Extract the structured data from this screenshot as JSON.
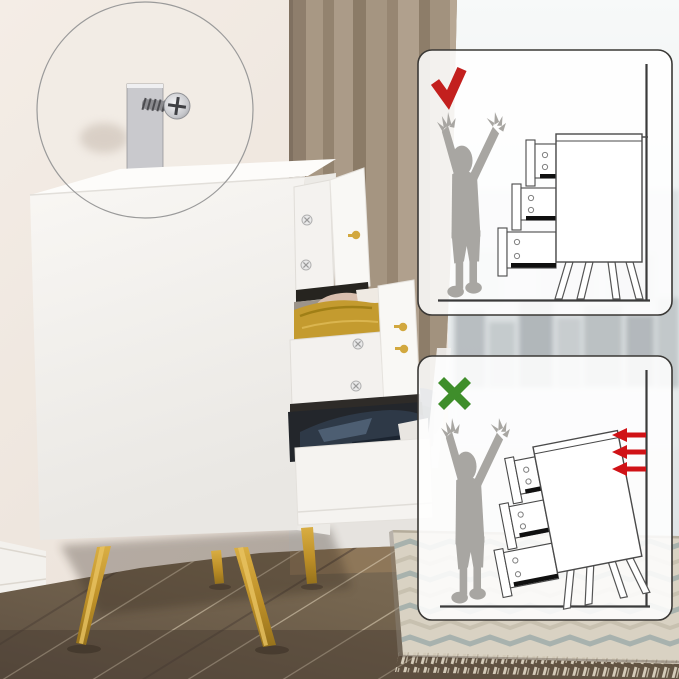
{
  "scene": {
    "kind": "furniture-product-photo",
    "subject": "white-dresser-with-gold-legs-and-open-drawers",
    "feature": "anti-tip-wall-anchor-kit",
    "environment": [
      "bedroom-wall",
      "curtain",
      "window-city-view",
      "wood-floor",
      "tassel-rug"
    ]
  },
  "magnifier": {
    "icon": "magnifier-circle",
    "shows": "metal-anchor-strap-and-screw"
  },
  "panels": {
    "secured": {
      "icon": "check-icon",
      "scene": "child-reaching-dresser-anchored-to-wall-stays-upright"
    },
    "unsecured": {
      "icon": "x-icon",
      "scene": "child-reaching-unanchored-dresser-tips-forward",
      "force_arrows": 3
    }
  },
  "colors": {
    "wall": "#efe7df",
    "curtain": "#a3937f",
    "curtain_dark": "#8b7b67",
    "window_haze": "#eef1f2",
    "city": "#aeb4b8",
    "floor": "#74644f",
    "plank_seam": "#d9cbb2",
    "rug_base": "#d9d2c3",
    "rug_stripe": "#9fadaa",
    "rug_stripe_alt": "#c6bfae",
    "rug_fringe": "#d3cab8",
    "dresser_white": "#f6f4f1",
    "gold_leg": "#c79b33",
    "gold_knob": "#d2a83e",
    "metal_bracket": "#c9c9cd",
    "navy_clothes": "#2e3947",
    "mustard_blanket": "#c49b2f",
    "blush_cloth": "#d9bfae",
    "pillow_slate": "#4e5a63",
    "bed_white": "#e9e8e6",
    "panel_fill": "#ffffff",
    "panel_border": "#3a3835",
    "outline_dark": "#3b3b3b",
    "check_red": "#c3201e",
    "cross_green": "#3f8e2b",
    "arrow_red": "#d01216",
    "silhouette_gray": "#a8a6a2"
  }
}
